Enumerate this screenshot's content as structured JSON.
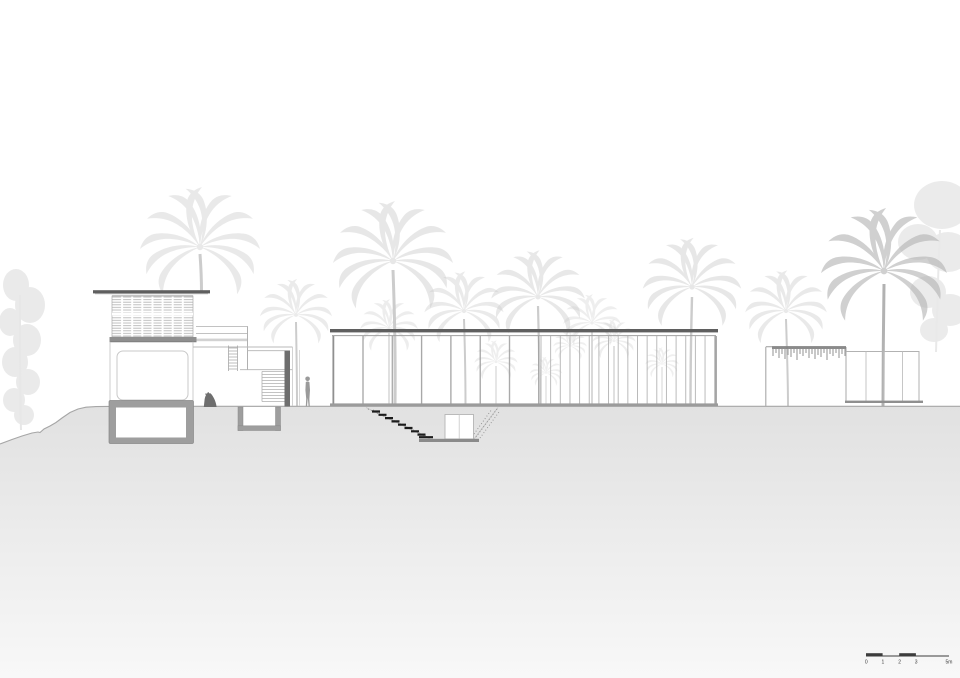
{
  "scale_bar": {
    "labels": [
      "0",
      "1",
      "2",
      "3",
      "5m"
    ]
  },
  "colors": {
    "ink": "#5f5f5f",
    "poche": "#9e9e9e",
    "outline": "#a8a8a8",
    "faint": "#c6c6c6",
    "vegetation": "#cccccc",
    "vegetation_dark": "#b2b2b2",
    "ground_top": "#e1e1e1",
    "ground_bottom": "#f8f8f8",
    "figure_dark": "#6e6e6e",
    "figure_light": "#9a9a9a",
    "stair_black": "#1c1c1c",
    "scale_ink": "#3c3c3c",
    "background": "#ffffff"
  }
}
